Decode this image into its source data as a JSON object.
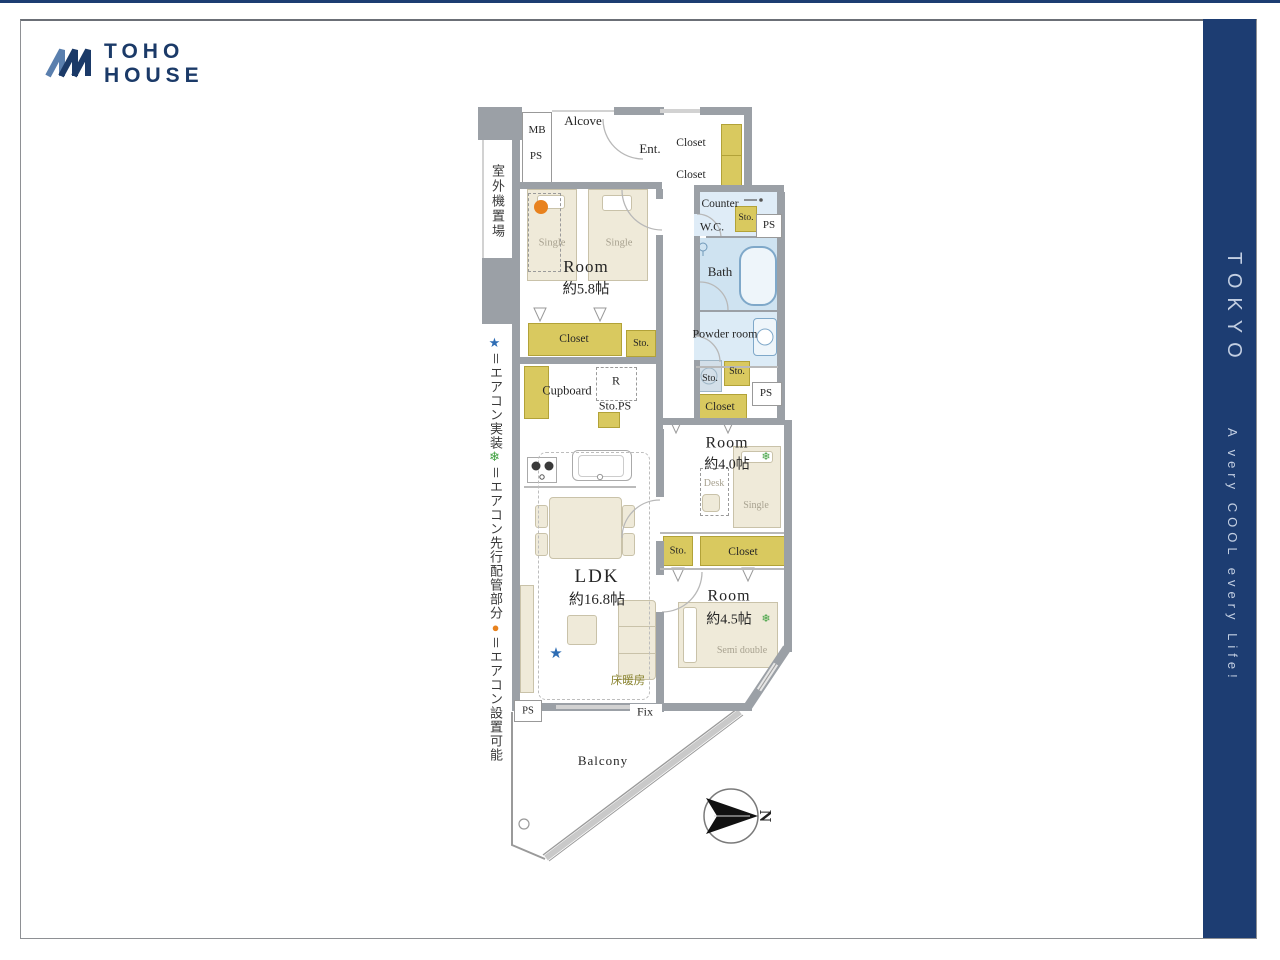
{
  "colors": {
    "navy": "#1d3d72",
    "logo_navy": "#1b3a68",
    "sidebar_text": "#c3cfe2",
    "closet_yellow": "#d9c95f",
    "bath_blue": "#cfe3f1",
    "powder_blue": "#dcebf6",
    "wc_blue": "#dfecf7",
    "wall_gray": "#9ba0a6",
    "furniture_beige": "#efead9",
    "star_blue": "#2e6db4",
    "snow_green": "#3fa03f",
    "dot_orange": "#e8821e",
    "floor_heating_text": "#8a8430"
  },
  "logo": {
    "line1": "TOHO",
    "line2": "HOUSE"
  },
  "sidebar": {
    "title": "TOKYO",
    "tagline": "A very COOL every Life!"
  },
  "legend": {
    "outdoor_unit": "室外機置場",
    "star": "★",
    "star_label": "＝エアコン実装",
    "snow": "❄",
    "snow_label": "＝エアコン先行配管部分",
    "dot": "●",
    "dot_label": "＝エアコン設置可能"
  },
  "plan": {
    "alcove": "Alcove",
    "mb": "MB",
    "ps_top": "PS",
    "ent": "Ent.",
    "closet_ent_1": "Closet",
    "closet_ent_2": "Closet",
    "counter": "Counter",
    "wc": "W.C.",
    "sto_wc": "Sto.",
    "ps_wc": "PS",
    "bath": "Bath",
    "powder_room": "Powder room",
    "sto_wash": "Sto.",
    "sto_mid": "Sto.",
    "ps_mid": "PS",
    "closet_mid": "Closet",
    "room1_name": "Room",
    "room1_size": "約5.8帖",
    "single_1": "Single",
    "single_2": "Single",
    "closet_r1": "Closet",
    "sto_r1": "Sto.",
    "cupboard": "Cupboard",
    "fridge": "R",
    "sto_ps": "Sto.PS",
    "room2_name": "Room",
    "room2_size": "約4.0帖",
    "desk": "Desk",
    "single_3": "Single",
    "sto_row": "Sto.",
    "closet_row": "Closet",
    "room3_name": "Room",
    "room3_size": "約4.5帖",
    "semi_double": "Semi double",
    "ldk_name": "LDK",
    "ldk_size": "約16.8帖",
    "floor_heating": "床暖房",
    "ps_bottom": "PS",
    "fix": "Fix",
    "balcony": "Balcony",
    "north": "N"
  }
}
